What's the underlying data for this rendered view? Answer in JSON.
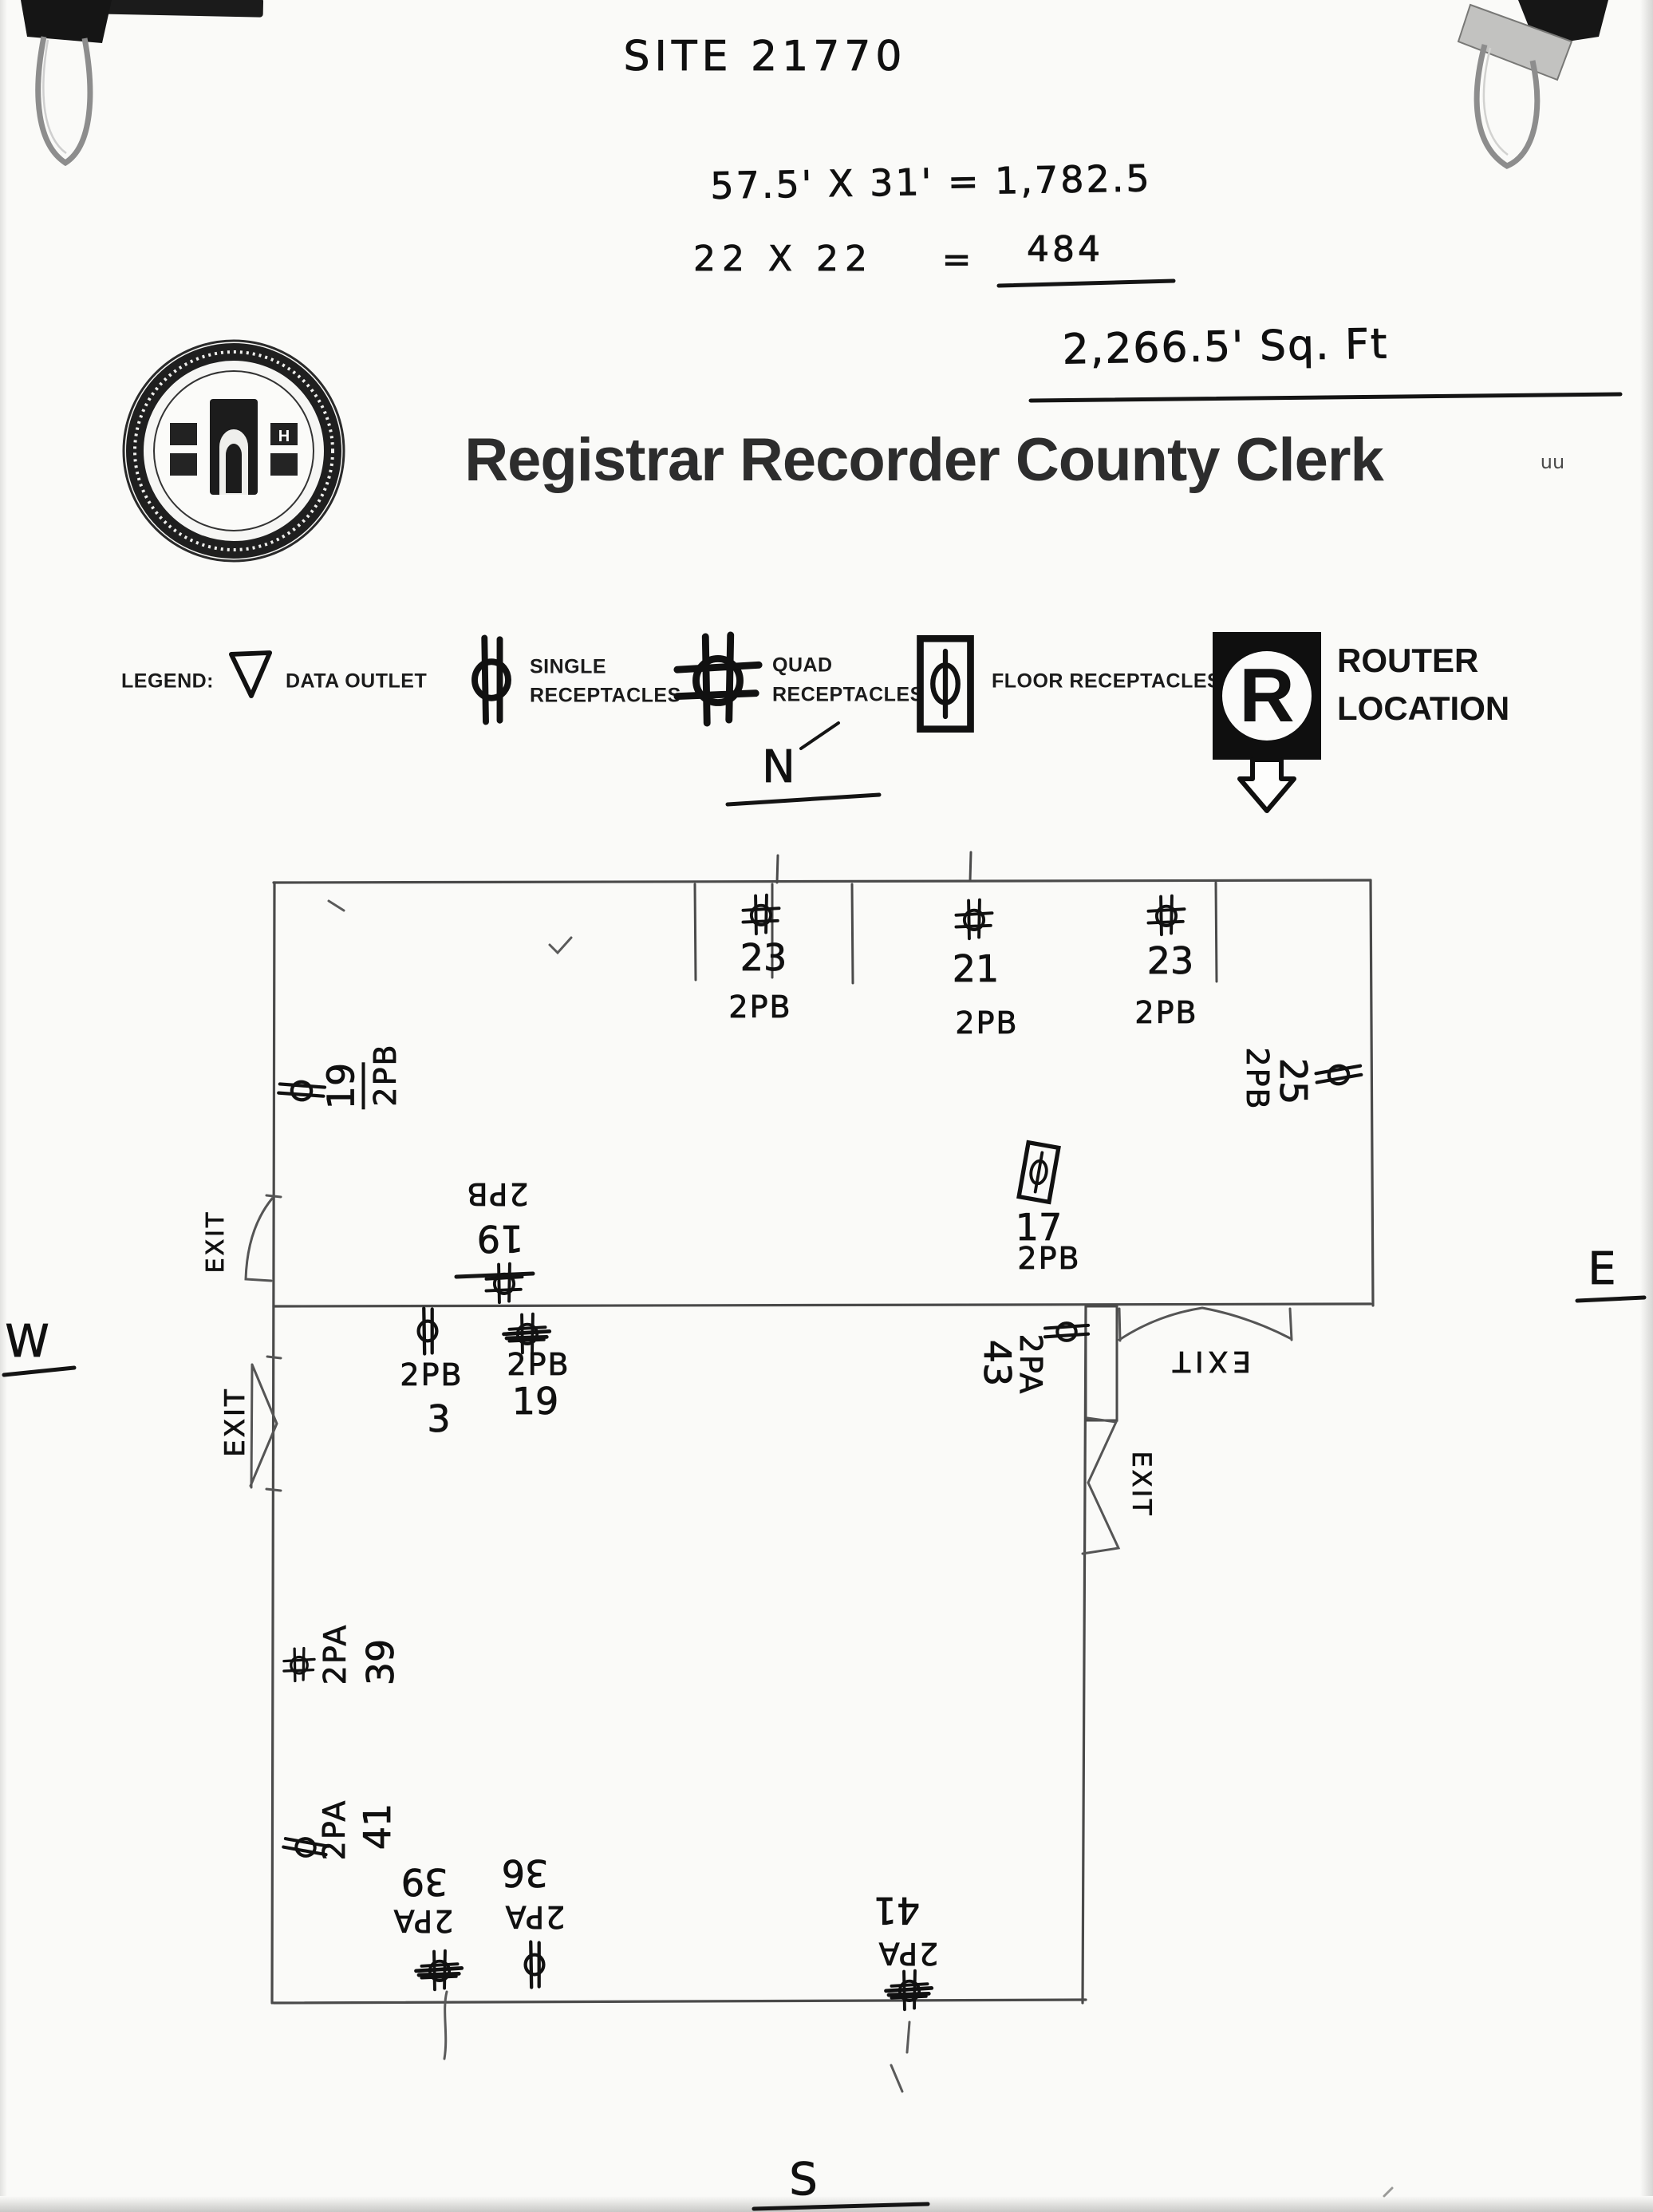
{
  "photo": {
    "site_code": "SITE 21770",
    "calc_line1": "57.5' X 31' = 1,782.5",
    "calc_line2_left": "22 X 22",
    "calc_line2_eq": "=",
    "calc_line2_result": "484",
    "calc_total": "2,266.5' Sq. Ft",
    "stray_mark": "uu"
  },
  "header": {
    "title": "Registrar Recorder County Clerk"
  },
  "legend": {
    "label": "LEGEND:",
    "items": [
      {
        "icon": "data-outlet-icon",
        "line1": "DATA OUTLET",
        "line2": ""
      },
      {
        "icon": "single-receptacle-icon",
        "line1": "SINGLE",
        "line2": "RECEPTACLES"
      },
      {
        "icon": "quad-receptacle-icon",
        "line1": "QUAD",
        "line2": "RECEPTACLES"
      },
      {
        "icon": "floor-receptacle-icon",
        "line1": "FLOOR RECEPTACLES",
        "line2": ""
      },
      {
        "icon": "router-location-icon",
        "line1": "ROUTER",
        "line2": "LOCATION",
        "symbol_letter": "R"
      }
    ]
  },
  "compass": {
    "north": "N",
    "west": "W",
    "east": "E",
    "south": "S"
  },
  "plan": {
    "exit_label": "EXIT",
    "outlets": [
      {
        "type": "quad",
        "num": "23",
        "circuit": "2PB",
        "location": "top-wall-left"
      },
      {
        "type": "quad",
        "num": "21",
        "circuit": "2PB",
        "location": "top-wall-center"
      },
      {
        "type": "quad",
        "num": "23",
        "circuit": "2PB",
        "location": "top-wall-right"
      },
      {
        "type": "single",
        "num": "19",
        "circuit": "2PB",
        "location": "west-wall-upper"
      },
      {
        "type": "quad",
        "num": "19",
        "circuit": "2PB",
        "location": "interior-wall-north"
      },
      {
        "type": "single",
        "num": "3",
        "circuit": "2PB",
        "location": "interior-wall-south-left"
      },
      {
        "type": "quad-crossed",
        "num": "19",
        "circuit": "2PB",
        "location": "interior-wall-south-right"
      },
      {
        "type": "floor",
        "num": "17",
        "circuit": "2PB",
        "location": "upper-room"
      },
      {
        "type": "single",
        "num": "25",
        "circuit": "2PB",
        "location": "east-wall"
      },
      {
        "type": "single",
        "num": "43",
        "circuit": "2PA",
        "location": "interior-notch"
      },
      {
        "type": "quad",
        "num": "39",
        "circuit": "2PA",
        "location": "west-wall-mid"
      },
      {
        "type": "single",
        "num": "41",
        "circuit": "2PA",
        "location": "west-wall-lower"
      },
      {
        "type": "quad-crossed",
        "num": "39",
        "circuit": "2PA",
        "location": "south-wall-left"
      },
      {
        "type": "single",
        "num": "36",
        "circuit": "2PA",
        "location": "south-wall-left2"
      },
      {
        "type": "quad-crossed",
        "num": "41",
        "circuit": "2PA",
        "location": "south-wall-mid"
      }
    ]
  }
}
